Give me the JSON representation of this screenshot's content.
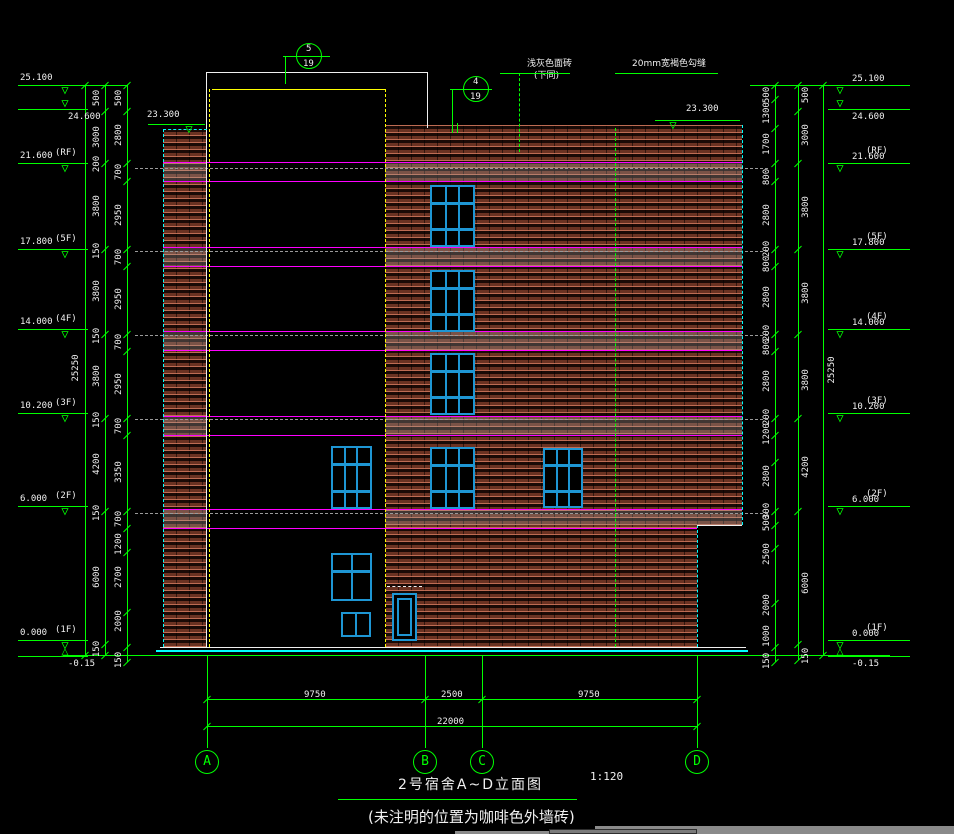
{
  "titleblock": {
    "title": "2号宿舍A~D立面图",
    "scale": "1:120",
    "note": "(未注明的位置为咖啡色外墙砖)"
  },
  "annotations": {
    "note1": "浅灰色面砖",
    "note1b": "(下同)",
    "note2": "20mm宽褐色勾缝",
    "parapet_level_left": "23.300",
    "parapet_level_right": "23.300"
  },
  "colors": {
    "green": "#00ff00",
    "white": "#f0f0f0",
    "magenta": "#ff00ff",
    "cyan": "#00ffff",
    "yellow": "#ffff00",
    "gray": "#9a9a9a",
    "window_blue": "#1e96d4",
    "brick_face": "#6e3424",
    "band_tint": "rgba(170,170,170,0.28)"
  },
  "callouts": [
    {
      "num": "5",
      "sheet": "19",
      "cx": 309,
      "cy": 56,
      "r": 13,
      "stem_x": 285,
      "stem_y1": 56,
      "stem_y2": 84,
      "div_x1": 283,
      "div_x2": 330
    },
    {
      "num": "4",
      "sheet": "19",
      "cx": 476,
      "cy": 89,
      "r": 13,
      "stem_x": 452,
      "stem_y1": 89,
      "stem_y2": 127,
      "div_x1": 450,
      "div_x2": 492
    }
  ],
  "levels": {
    "left": [
      {
        "v": "25.100",
        "f": "",
        "y": 85
      },
      {
        "v": "24.600",
        "f": "",
        "y": 109,
        "below": true
      },
      {
        "v": "21.600",
        "f": "(RF)",
        "y": 163
      },
      {
        "v": "17.800",
        "f": "(5F)",
        "y": 249
      },
      {
        "v": "14.000",
        "f": "(4F)",
        "y": 329
      },
      {
        "v": "10.200",
        "f": "(3F)",
        "y": 413
      },
      {
        "v": "6.000",
        "f": "(2F)",
        "y": 506
      },
      {
        "v": "0.000",
        "f": "(1F)",
        "y": 640,
        "bowtie": true
      },
      {
        "v": "-0.15",
        "f": "",
        "y": 656,
        "below": true,
        "notri": true
      }
    ],
    "right": [
      {
        "v": "25.100",
        "f": "",
        "y": 85
      },
      {
        "v": "24.600",
        "f": "",
        "y": 109,
        "below": true
      },
      {
        "v": "21.600",
        "f": "(RF)",
        "y": 163
      },
      {
        "v": "17.800",
        "f": "(5F)",
        "y": 249
      },
      {
        "v": "14.000",
        "f": "(4F)",
        "y": 329
      },
      {
        "v": "10.200",
        "f": "(3F)",
        "y": 413
      },
      {
        "v": "6.000",
        "f": "(2F)",
        "y": 506
      },
      {
        "v": "0.000",
        "f": "(1F)",
        "y": 640,
        "bowtie": true
      },
      {
        "v": "-0.15",
        "f": "",
        "y": 656,
        "below": true,
        "notri": true
      }
    ]
  },
  "parapet_markers": [
    {
      "t": "23.300",
      "tx": 147,
      "ty": 110,
      "tri_x": 180,
      "tri_y": 124
    },
    {
      "t": "23.300",
      "tx": 686,
      "ty": 104,
      "tri_x": 664,
      "tri_y": 120
    }
  ],
  "dimcols": [
    {
      "name": "left-overall",
      "x": 85,
      "label_x": 76,
      "ticks": [
        85,
        655
      ],
      "labels": [
        [
          "25250",
          368
        ]
      ]
    },
    {
      "name": "left-a",
      "x": 105,
      "label_x": 97,
      "ticks": [
        85,
        111,
        163,
        249,
        334,
        418,
        511,
        644,
        655
      ],
      "labels": [
        [
          "500",
          98
        ],
        [
          "3000",
          137
        ],
        [
          "200",
          164
        ],
        [
          "3800",
          206
        ],
        [
          "150",
          251
        ],
        [
          "3800",
          291
        ],
        [
          "150",
          336
        ],
        [
          "3800",
          376
        ],
        [
          "150",
          420
        ],
        [
          "4200",
          464
        ],
        [
          "150",
          513
        ],
        [
          "6000",
          577
        ],
        [
          "150",
          649
        ]
      ]
    },
    {
      "name": "left-b",
      "x": 127,
      "label_x": 119,
      "ticks": [
        85,
        111,
        163,
        181,
        249,
        266,
        334,
        351,
        418,
        435,
        511,
        528,
        552,
        612,
        647,
        662
      ],
      "labels": [
        [
          "500",
          98
        ],
        [
          "2800",
          135
        ],
        [
          "700",
          172
        ],
        [
          "2950",
          215
        ],
        [
          "700",
          257
        ],
        [
          "2950",
          299
        ],
        [
          "700",
          342
        ],
        [
          "2950",
          384
        ],
        [
          "700",
          426
        ],
        [
          "3350",
          472
        ],
        [
          "700",
          519
        ],
        [
          "1200",
          544
        ],
        [
          "2700",
          577
        ],
        [
          "2000",
          621
        ],
        [
          "150",
          660
        ]
      ]
    },
    {
      "name": "right-b",
      "x": 775,
      "label_x": 767,
      "ticks": [
        85,
        99,
        128,
        163,
        181,
        249,
        266,
        334,
        351,
        418,
        435,
        462,
        511,
        525,
        548,
        603,
        647,
        662
      ],
      "labels": [
        [
          "500",
          95
        ],
        [
          "1300",
          113
        ],
        [
          "1700",
          144
        ],
        [
          "800",
          177
        ],
        [
          "2800",
          215
        ],
        [
          "200",
          249
        ],
        [
          "800",
          264
        ],
        [
          "2800",
          297
        ],
        [
          "200",
          333
        ],
        [
          "800",
          347
        ],
        [
          "2800",
          381
        ],
        [
          "200",
          417
        ],
        [
          "1200",
          434
        ],
        [
          "2800",
          476
        ],
        [
          "300",
          511
        ],
        [
          "500",
          523
        ],
        [
          "2500",
          554
        ],
        [
          "2000",
          605
        ],
        [
          "1000",
          636
        ],
        [
          "150",
          661
        ]
      ]
    },
    {
      "name": "right-a",
      "x": 798,
      "label_x": 806,
      "ticks": [
        85,
        111,
        163,
        249,
        334,
        418,
        511,
        644,
        660
      ],
      "labels": [
        [
          "500",
          95
        ],
        [
          "3000",
          135
        ],
        [
          "3800",
          207
        ],
        [
          "3800",
          293
        ],
        [
          "3800",
          380
        ],
        [
          "4200",
          467
        ],
        [
          "6000",
          583
        ],
        [
          "150",
          656
        ]
      ]
    },
    {
      "name": "right-overall",
      "x": 823,
      "label_x": 832,
      "ticks": [
        85,
        655
      ],
      "labels": [
        [
          "25250",
          370
        ]
      ]
    }
  ],
  "grid": {
    "bubbles": [
      {
        "label": "A",
        "x": 207
      },
      {
        "label": "B",
        "x": 425
      },
      {
        "label": "C",
        "x": 482
      },
      {
        "label": "D",
        "x": 697
      }
    ],
    "cy": 762,
    "r": 12,
    "vert_top": 655,
    "vert_bottom": 748,
    "dim_y": 699,
    "dims": [
      {
        "t": "9750",
        "x": 316
      },
      {
        "t": "2500",
        "x": 453
      },
      {
        "t": "9750",
        "x": 590
      }
    ],
    "total_y": 726,
    "total": {
      "t": "22000",
      "x": 452
    },
    "x1": 207,
    "x2": 697
  },
  "bands": {
    "pair_tops": [
      162,
      247,
      331,
      416,
      509
    ],
    "pair_bots": [
      181,
      266,
      350,
      435,
      528
    ],
    "x_segs": [
      [
        163,
        207
      ],
      [
        385,
        742
      ]
    ],
    "last_right_end": 697
  },
  "slab_lines_y": [
    168,
    251,
    335,
    419,
    513
  ],
  "rects": [
    [
      "strip-brick",
      163,
      129,
      44,
      518,
      "brick"
    ],
    [
      "wall-upper-brick",
      385,
      125,
      357,
      400,
      "brick"
    ],
    [
      "wall-lower-brick",
      385,
      525,
      312,
      122,
      "brick"
    ]
  ],
  "windows": [
    {
      "x": 430,
      "y": 185,
      "w": 45,
      "h": 62,
      "type": "w9"
    },
    {
      "x": 430,
      "y": 270,
      "w": 45,
      "h": 62,
      "type": "w9"
    },
    {
      "x": 430,
      "y": 353,
      "w": 45,
      "h": 62,
      "type": "w9"
    },
    {
      "x": 430,
      "y": 447,
      "w": 45,
      "h": 62,
      "type": "w9"
    },
    {
      "x": 331,
      "y": 446,
      "w": 41,
      "h": 63,
      "type": "w9"
    },
    {
      "x": 543,
      "y": 448,
      "w": 40,
      "h": 60,
      "type": "w9"
    },
    {
      "x": 331,
      "y": 553,
      "w": 41,
      "h": 48,
      "type": "w4"
    },
    {
      "x": 341,
      "y": 612,
      "w": 30,
      "h": 25,
      "type": "w2"
    },
    {
      "x": 392,
      "y": 593,
      "w": 25,
      "h": 48,
      "type": "door"
    }
  ],
  "lines": [
    [
      "top-tie-left",
      88,
      85,
      39,
      "h",
      "g",
      0,
      1
    ],
    [
      "top-tie-right",
      750,
      85,
      80,
      "h",
      "g",
      0,
      1
    ],
    [
      "left-overall-line",
      85,
      85,
      570,
      "v",
      "g",
      0,
      1
    ],
    [
      "left-a-line",
      105,
      85,
      570,
      "v",
      "g",
      0,
      1
    ],
    [
      "left-b-line",
      127,
      85,
      577,
      "v",
      "g",
      0,
      1
    ],
    [
      "right-b-line",
      775,
      85,
      577,
      "v",
      "g",
      0,
      1
    ],
    [
      "right-a-line",
      798,
      85,
      575,
      "v",
      "g",
      0,
      1
    ],
    [
      "right-overall-line",
      823,
      85,
      570,
      "v",
      "g",
      0,
      1
    ],
    [
      "parapet23-left-line",
      148,
      124,
      57,
      "h",
      "g",
      0,
      1
    ],
    [
      "parapet23-right-line",
      655,
      120,
      85,
      "h",
      "g",
      0,
      1
    ],
    [
      "parapet-top-white",
      206,
      72,
      221,
      "h",
      "w",
      0,
      1
    ],
    [
      "parapet-right-white",
      427,
      72,
      56,
      "v",
      "w",
      0,
      1
    ],
    [
      "tower-left-white",
      206,
      72,
      575,
      "v",
      "w",
      0,
      1
    ],
    [
      "parapet-yellow",
      212,
      89,
      173,
      "h",
      "y",
      0,
      1
    ],
    [
      "tower-left-yellow-dash",
      209,
      89,
      558,
      "v",
      "y",
      1,
      1
    ],
    [
      "tower-right-yellow-dash",
      385,
      89,
      558,
      "v",
      "y",
      1,
      1
    ],
    [
      "joint-green-dash",
      615,
      128,
      519,
      "v",
      "g",
      1,
      1
    ],
    [
      "note1-leader-dash",
      519,
      73,
      79,
      "v",
      "g",
      1,
      1
    ],
    [
      "callout4-stem",
      452,
      89,
      38,
      "v",
      "g",
      0,
      1
    ],
    [
      "callout5-stem",
      285,
      56,
      28,
      "v",
      "g",
      0,
      1
    ],
    [
      "note1-underline",
      500,
      73,
      70,
      "h",
      "g",
      0,
      1
    ],
    [
      "note2-underline",
      615,
      73,
      103,
      "h",
      "g",
      0,
      1
    ],
    [
      "strip-left-cyan-dash",
      163,
      129,
      518,
      "v",
      "c",
      1,
      1
    ],
    [
      "strip-top-cyan-dash",
      163,
      129,
      44,
      "h",
      "c",
      1,
      1
    ],
    [
      "wall-right-cyan-dash",
      742,
      125,
      400,
      "v",
      "c",
      1,
      1
    ],
    [
      "wall-step-cyan-dash",
      697,
      525,
      122,
      "v",
      "c",
      1,
      1
    ],
    [
      "step-top-white",
      697,
      525,
      45,
      "h",
      "w",
      0,
      1
    ],
    [
      "ground-white",
      160,
      647,
      586,
      "h",
      "w",
      0,
      1
    ],
    [
      "ground-cyan",
      156,
      650,
      592,
      "h",
      "c",
      0,
      2
    ],
    [
      "dim-baseline",
      63,
      655,
      827,
      "h",
      "g",
      0,
      1
    ],
    [
      "door-lintel-dash",
      387,
      586,
      35,
      "h",
      "w",
      1,
      1
    ],
    [
      "stem-tick-a",
      452,
      123,
      10,
      "v",
      "g",
      0,
      1
    ],
    [
      "stem-tick-b",
      457,
      123,
      10,
      "v",
      "g",
      0,
      1
    ],
    [
      "title-underline",
      338,
      799,
      239,
      "h",
      "g",
      0,
      1
    ]
  ]
}
